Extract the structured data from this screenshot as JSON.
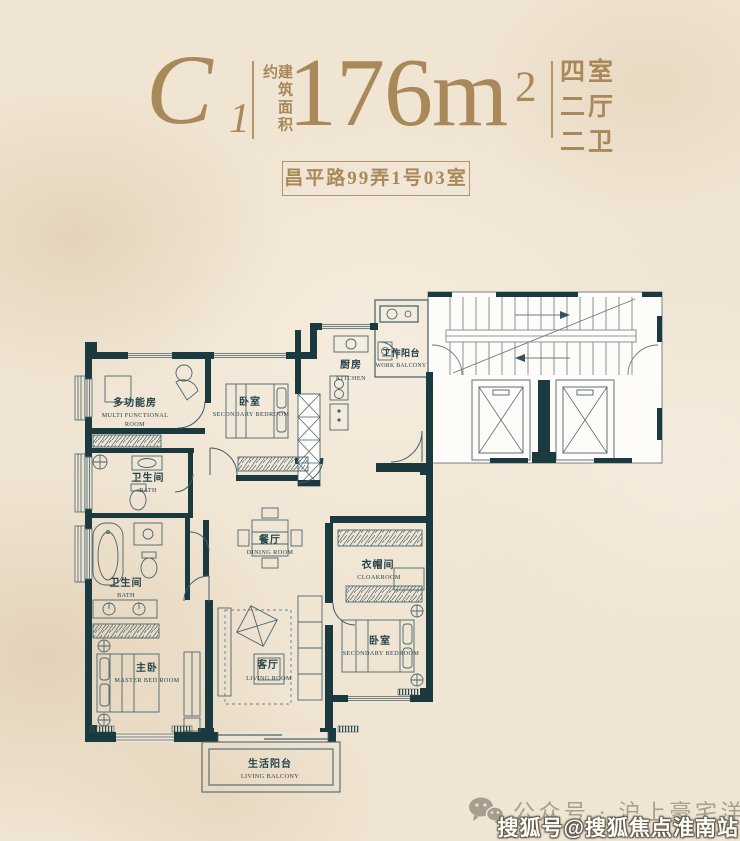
{
  "header": {
    "unit_letter": "C",
    "unit_number": "1",
    "area_label_vertical": "建筑面积约",
    "area_value": "176m",
    "area_sup": "2",
    "room_config": [
      "四室",
      "二厅",
      "二卫"
    ],
    "address": "昌平路99弄1号03室"
  },
  "floorplan": {
    "rooms": [
      {
        "id": "multi-functional-room",
        "cn": "多功能房",
        "en1": "MULTI FUNCTIONAL",
        "en2": "ROOM"
      },
      {
        "id": "secondary-bedroom-top",
        "cn": "卧室",
        "en1": "SECONDARY BEDROOM"
      },
      {
        "id": "kitchen",
        "cn": "厨房",
        "en1": "KITCHEN"
      },
      {
        "id": "work-balcony",
        "cn": "工作阳台",
        "en1": "WORK BALCONY"
      },
      {
        "id": "bath-1",
        "cn": "卫生间",
        "en1": "BATH"
      },
      {
        "id": "dining-room",
        "cn": "餐厅",
        "en1": "DINING ROOM"
      },
      {
        "id": "cloakroom",
        "cn": "衣帽间",
        "en1": "CLOAKROOM"
      },
      {
        "id": "bath-2",
        "cn": "卫生间",
        "en1": "BATH"
      },
      {
        "id": "master-bedroom",
        "cn": "主卧",
        "en1": "MASTER BED ROOM"
      },
      {
        "id": "living-room",
        "cn": "客厅",
        "en1": "LIVING ROOM"
      },
      {
        "id": "secondary-bedroom-bottom",
        "cn": "卧室",
        "en1": "SECONDARY BEDROOM"
      },
      {
        "id": "living-balcony",
        "cn": "生活阳台",
        "en1": "LIVING BALCONY"
      }
    ]
  },
  "footer": {
    "wechat_text": "公众号 · 沪上豪宅洋房",
    "watermark": "搜狐号@搜狐焦点淮南站"
  },
  "colors": {
    "background": "#f0e5d3",
    "gold": "#a9895a",
    "wall": "#1b3a40",
    "line": "#48636c",
    "label": "#24434b",
    "footer_gray": "#a79e90",
    "watermark_text": "#fffdf8"
  }
}
